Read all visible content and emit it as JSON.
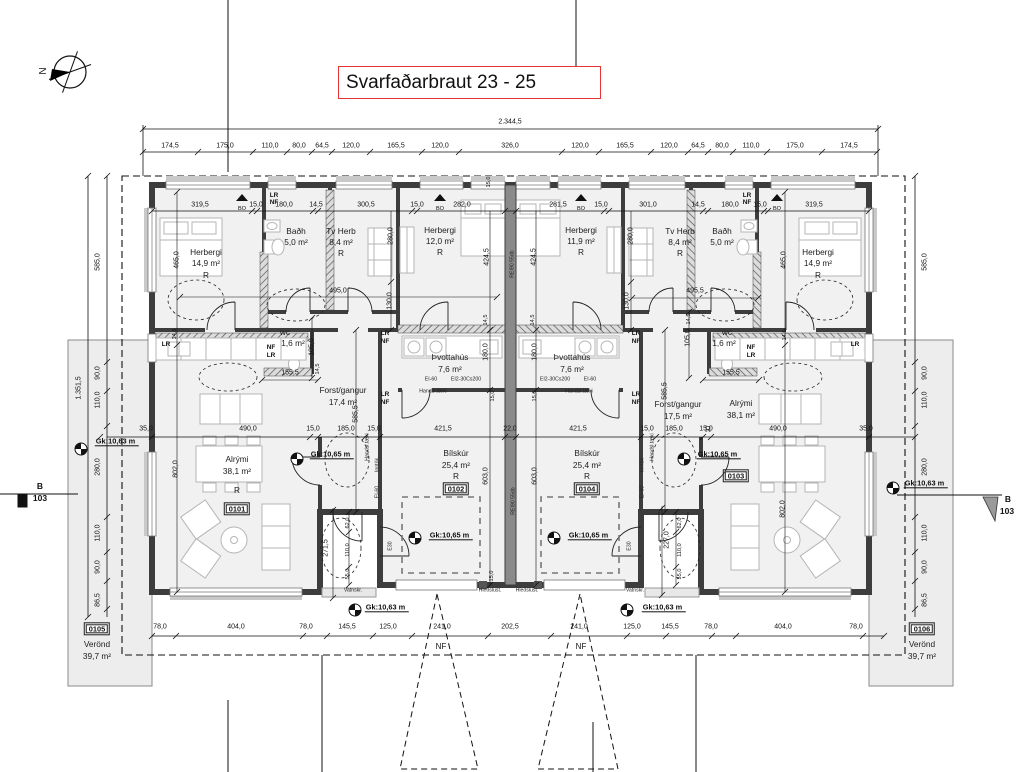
{
  "meta": {
    "title": "Svarfaðarbraut 23 - 25"
  },
  "north_label": "N",
  "colors": {
    "title_box_border": "#e53434",
    "wall": "#3d3d3d",
    "floor": "#f1f1f1",
    "terrace": "#ededed",
    "furniture": "#b5b5b5",
    "line": "#111111"
  },
  "labels": [
    [
      "2.344,5",
      510,
      122,
      "d",
      0
    ],
    [
      "174,5",
      170,
      146,
      "d",
      0
    ],
    [
      "175,0",
      225,
      146,
      "d",
      0
    ],
    [
      "110,0",
      270,
      146,
      "d",
      0
    ],
    [
      "80,0",
      299,
      146,
      "d",
      0
    ],
    [
      "64,5",
      322,
      146,
      "d",
      0
    ],
    [
      "120,0",
      351,
      146,
      "d",
      0
    ],
    [
      "165,5",
      396,
      146,
      "d",
      0
    ],
    [
      "120,0",
      440,
      146,
      "d",
      0
    ],
    [
      "326,0",
      510,
      146,
      "d",
      0
    ],
    [
      "120,0",
      580,
      146,
      "d",
      0
    ],
    [
      "165,5",
      625,
      146,
      "d",
      0
    ],
    [
      "120,0",
      669,
      146,
      "d",
      0
    ],
    [
      "64,5",
      698,
      146,
      "d",
      0
    ],
    [
      "80,0",
      722,
      146,
      "d",
      0
    ],
    [
      "110,0",
      751,
      146,
      "d",
      0
    ],
    [
      "175,0",
      795,
      146,
      "d",
      0
    ],
    [
      "174,5",
      849,
      146,
      "d",
      0
    ],
    [
      "319,5",
      200,
      205,
      "d",
      0
    ],
    [
      "15,0",
      256,
      205,
      "d",
      0
    ],
    [
      "180,0",
      284,
      205,
      "d",
      0
    ],
    [
      "14,5",
      316,
      205,
      "d",
      0
    ],
    [
      "300,5",
      366,
      205,
      "d",
      0
    ],
    [
      "15,0",
      417,
      205,
      "d",
      0
    ],
    [
      "282,0",
      462,
      205,
      "d",
      0
    ],
    [
      "281,5",
      558,
      205,
      "d",
      0
    ],
    [
      "15,0",
      601,
      205,
      "d",
      0
    ],
    [
      "301,0",
      648,
      205,
      "d",
      0
    ],
    [
      "14,5",
      698,
      205,
      "d",
      0
    ],
    [
      "180,0",
      730,
      205,
      "d",
      0
    ],
    [
      "15,0",
      760,
      205,
      "d",
      0
    ],
    [
      "319,5",
      814,
      205,
      "d",
      0
    ],
    [
      "BO",
      242,
      210,
      "ds",
      0
    ],
    [
      "BO",
      440,
      210,
      "ds",
      0
    ],
    [
      "BO",
      581,
      210,
      "ds",
      0
    ],
    [
      "BO",
      777,
      210,
      "ds",
      0
    ],
    [
      "35,0",
      146,
      429,
      "d",
      0
    ],
    [
      "490,0",
      248,
      429,
      "d",
      0
    ],
    [
      "15,0",
      313,
      429,
      "d",
      0
    ],
    [
      "185,0",
      346,
      429,
      "d",
      0
    ],
    [
      "15,0",
      374,
      429,
      "d",
      0
    ],
    [
      "421,5",
      443,
      429,
      "d",
      0
    ],
    [
      "22,0",
      510,
      429,
      "d",
      0
    ],
    [
      "421,5",
      578,
      429,
      "d",
      0
    ],
    [
      "15,0",
      647,
      429,
      "d",
      0
    ],
    [
      "185,0",
      674,
      429,
      "d",
      0
    ],
    [
      "15,0",
      706,
      429,
      "d",
      0
    ],
    [
      "490,0",
      778,
      429,
      "d",
      0
    ],
    [
      "35,0",
      866,
      429,
      "d",
      0
    ],
    [
      "78,0",
      160,
      627,
      "d",
      0
    ],
    [
      "404,0",
      236,
      627,
      "d",
      0
    ],
    [
      "78,0",
      306,
      627,
      "d",
      0
    ],
    [
      "145,5",
      347,
      627,
      "d",
      0
    ],
    [
      "125,0",
      388,
      627,
      "d",
      0
    ],
    [
      "241,0",
      442,
      627,
      "d",
      0
    ],
    [
      "202,5",
      510,
      627,
      "d",
      0
    ],
    [
      "241,0",
      579,
      627,
      "d",
      0
    ],
    [
      "125,0",
      632,
      627,
      "d",
      0
    ],
    [
      "145,5",
      670,
      627,
      "d",
      0
    ],
    [
      "78,0",
      711,
      627,
      "d",
      0
    ],
    [
      "404,0",
      783,
      627,
      "d",
      0
    ],
    [
      "78,0",
      856,
      627,
      "d",
      0
    ],
    [
      "NF",
      441,
      647,
      "nfd",
      0
    ],
    [
      "NF",
      581,
      647,
      "nfd",
      0
    ],
    [
      "495,0",
      338,
      291,
      "d",
      0
    ],
    [
      "495,5",
      695,
      291,
      "d",
      0
    ],
    [
      "155,5",
      290,
      373,
      "d",
      0
    ],
    [
      "155,5",
      731,
      373,
      "d",
      0
    ],
    [
      "585,0",
      98,
      262,
      "d",
      1
    ],
    [
      "90,0",
      98,
      373,
      "d",
      1
    ],
    [
      "110,0",
      98,
      400,
      "d",
      1
    ],
    [
      "280,0",
      98,
      467,
      "d",
      1
    ],
    [
      "110,0",
      98,
      533,
      "d",
      1
    ],
    [
      "90,0",
      98,
      567,
      "d",
      1
    ],
    [
      "86,5",
      98,
      600,
      "d",
      1
    ],
    [
      "1.351,5",
      79,
      388,
      "d",
      1
    ],
    [
      "585,0",
      925,
      262,
      "d",
      1
    ],
    [
      "90,0",
      925,
      373,
      "d",
      1
    ],
    [
      "110,0",
      925,
      400,
      "d",
      1
    ],
    [
      "280,0",
      925,
      467,
      "d",
      1
    ],
    [
      "110,0",
      925,
      533,
      "d",
      1
    ],
    [
      "90,0",
      925,
      567,
      "d",
      1
    ],
    [
      "86,5",
      925,
      600,
      "d",
      1
    ],
    [
      "465,0",
      177,
      260,
      "d",
      1
    ],
    [
      "465,0",
      784,
      260,
      "d",
      1
    ],
    [
      "280,0",
      391,
      236,
      "d",
      1
    ],
    [
      "280,0",
      631,
      236,
      "d",
      1
    ],
    [
      "424,5",
      487,
      257,
      "d",
      1
    ],
    [
      "424,5",
      534,
      257,
      "d",
      1
    ],
    [
      "130,0",
      390,
      301,
      "d",
      1
    ],
    [
      "130,0",
      627,
      301,
      "d",
      1
    ],
    [
      "105,0",
      312,
      347,
      "d",
      1
    ],
    [
      "105,0",
      688,
      338,
      "d",
      1
    ],
    [
      "180,0",
      486,
      352,
      "d",
      1
    ],
    [
      "180,0",
      535,
      352,
      "d",
      1
    ],
    [
      "603,0",
      486,
      476,
      "d",
      1
    ],
    [
      "603,0",
      535,
      476,
      "d",
      1
    ],
    [
      "585,5",
      356,
      414,
      "d",
      1
    ],
    [
      "585,5",
      665,
      391,
      "d",
      1
    ],
    [
      "802,0",
      176,
      469,
      "d",
      1
    ],
    [
      "802,0",
      783,
      509,
      "d",
      1
    ],
    [
      "271,5",
      326,
      548,
      "d",
      1
    ],
    [
      "227,0",
      667,
      540,
      "d",
      1
    ],
    [
      "14,5",
      319,
      369,
      "ds",
      1
    ],
    [
      "14,5",
      690,
      319,
      "ds",
      1
    ],
    [
      "14,5",
      176,
      334,
      "ds",
      1
    ],
    [
      "14,5",
      786,
      335,
      "ds",
      1
    ],
    [
      "14,5",
      487,
      320,
      "ds",
      1
    ],
    [
      "14,5",
      534,
      320,
      "ds",
      1
    ],
    [
      "15,0",
      490,
      182,
      "ds",
      1
    ],
    [
      "15,0",
      494,
      396,
      "ds",
      1
    ],
    [
      "15,0",
      536,
      396,
      "ds",
      1
    ],
    [
      "15,0",
      493,
      576,
      "ds",
      1
    ],
    [
      "62,0",
      349,
      523,
      "ds",
      1
    ],
    [
      "62,0",
      681,
      523,
      "ds",
      1
    ],
    [
      "110,0",
      349,
      550,
      "ds",
      1
    ],
    [
      "110,0",
      681,
      550,
      "ds",
      1
    ],
    [
      "55,0",
      349,
      574,
      "ds",
      1
    ],
    [
      "55,0",
      681,
      574,
      "ds",
      1
    ],
    [
      "Herbergi",
      206,
      252,
      "rm",
      0
    ],
    [
      "14,9 m²",
      206,
      263,
      "rm",
      0
    ],
    [
      "R",
      206,
      275,
      "rm",
      0
    ],
    [
      "Baðh",
      296,
      231,
      "rm",
      0
    ],
    [
      "5,0 m²",
      296,
      242,
      "rm",
      0
    ],
    [
      "Tv Herb",
      341,
      231,
      "rm",
      0
    ],
    [
      "8,4 m²",
      341,
      242,
      "rm",
      0
    ],
    [
      "R",
      341,
      253,
      "rm",
      0
    ],
    [
      "Herbergi",
      440,
      230,
      "rm",
      0
    ],
    [
      "12,0 m²",
      440,
      241,
      "rm",
      0
    ],
    [
      "R",
      440,
      252,
      "rm",
      0
    ],
    [
      "Herbergi",
      581,
      230,
      "rm",
      0
    ],
    [
      "11,9 m²",
      581,
      241,
      "rm",
      0
    ],
    [
      "R",
      581,
      252,
      "rm",
      0
    ],
    [
      "Tv Herb",
      680,
      231,
      "rm",
      0
    ],
    [
      "8,4 m²",
      680,
      242,
      "rm",
      0
    ],
    [
      "R",
      680,
      253,
      "rm",
      0
    ],
    [
      "Baðh",
      722,
      231,
      "rm",
      0
    ],
    [
      "5,0 m²",
      722,
      242,
      "rm",
      0
    ],
    [
      "Herbergi",
      818,
      252,
      "rm",
      0
    ],
    [
      "14,9 m²",
      818,
      263,
      "rm",
      0
    ],
    [
      "R",
      818,
      275,
      "rm",
      0
    ],
    [
      "wc",
      285,
      332,
      "rm",
      0
    ],
    [
      "1,6 m²",
      293,
      343,
      "rm",
      0
    ],
    [
      "wc",
      727,
      332,
      "rm",
      0
    ],
    [
      "1,6 m²",
      724,
      343,
      "rm",
      0
    ],
    [
      "Þvottahús",
      450,
      357,
      "rm",
      0
    ],
    [
      "7,6 m²",
      450,
      369,
      "rm",
      0
    ],
    [
      "Þvottahús",
      572,
      357,
      "rm",
      0
    ],
    [
      "7,6 m²",
      572,
      369,
      "rm",
      0
    ],
    [
      "Forst/gangur",
      343,
      390,
      "rm",
      0
    ],
    [
      "17,4 m²",
      343,
      402,
      "rm",
      0
    ],
    [
      "Forst/gangur",
      678,
      404,
      "rm",
      0
    ],
    [
      "17,5 m²",
      678,
      416,
      "rm",
      0
    ],
    [
      "Alrými",
      237,
      459,
      "rm",
      0
    ],
    [
      "38,1 m²",
      237,
      471,
      "rm",
      0
    ],
    [
      "R",
      237,
      490,
      "rm",
      0
    ],
    [
      "Alrými",
      741,
      403,
      "rm",
      0
    ],
    [
      "38,1 m²",
      741,
      415,
      "rm",
      0
    ],
    [
      "R",
      708,
      429,
      "rm",
      0
    ],
    [
      "Bílskúr",
      456,
      453,
      "rm",
      0
    ],
    [
      "25,4 m²",
      456,
      465,
      "rm",
      0
    ],
    [
      "R",
      456,
      476,
      "rm",
      0
    ],
    [
      "Bílskúr",
      587,
      453,
      "rm",
      0
    ],
    [
      "25,4 m²",
      587,
      465,
      "rm",
      0
    ],
    [
      "R",
      587,
      476,
      "rm",
      0
    ],
    [
      "Verönd",
      97,
      644,
      "rm",
      0
    ],
    [
      "39,7 m²",
      97,
      656,
      "rm",
      0
    ],
    [
      "Verönd",
      922,
      644,
      "rm",
      0
    ],
    [
      "39,7 m²",
      922,
      656,
      "rm",
      0
    ],
    [
      "0101",
      237,
      509,
      "num",
      0
    ],
    [
      "0102",
      456,
      489,
      "num",
      0
    ],
    [
      "0103",
      736,
      476,
      "num",
      0
    ],
    [
      "0104",
      587,
      489,
      "num",
      0
    ],
    [
      "0105",
      97,
      629,
      "num",
      0
    ],
    [
      "0106",
      922,
      629,
      "num",
      0
    ],
    [
      "Gk:10,65 m",
      332,
      455,
      "gk",
      0
    ],
    [
      "Gk:10,65 m",
      719,
      455,
      "gk",
      0
    ],
    [
      "Gk:10,65 m",
      451,
      536,
      "gk",
      0
    ],
    [
      "Gk:10,65 m",
      590,
      536,
      "gk",
      0
    ],
    [
      "Gk:10,63 m",
      387,
      608,
      "gk",
      0
    ],
    [
      "Gk:10,63 m",
      664,
      608,
      "gk",
      0
    ],
    [
      "Gk:10,63 m",
      117,
      442,
      "gk",
      0
    ],
    [
      "Gk:10,63 m",
      926,
      484,
      "gk",
      0
    ],
    [
      "LR",
      274,
      196,
      "nf",
      0
    ],
    [
      "NF",
      274,
      203,
      "nf",
      0
    ],
    [
      "LR",
      747,
      196,
      "nf",
      0
    ],
    [
      "NF",
      747,
      203,
      "nf",
      0
    ],
    [
      "LR",
      166,
      345,
      "nf",
      0
    ],
    [
      "LR",
      855,
      345,
      "nf",
      0
    ],
    [
      "NF",
      271,
      348,
      "nf",
      0
    ],
    [
      "LR",
      271,
      356,
      "nf",
      0
    ],
    [
      "NF",
      751,
      348,
      "nf",
      0
    ],
    [
      "LR",
      751,
      356,
      "nf",
      0
    ],
    [
      "LR",
      385,
      334,
      "nf",
      0
    ],
    [
      "NF",
      385,
      342,
      "nf",
      0
    ],
    [
      "LR",
      636,
      334,
      "nf",
      0
    ],
    [
      "NF",
      636,
      342,
      "nf",
      0
    ],
    [
      "LR",
      385,
      395,
      "nf",
      0
    ],
    [
      "NF",
      385,
      403,
      "nf",
      0
    ],
    [
      "LR",
      636,
      395,
      "nf",
      0
    ],
    [
      "NF",
      636,
      403,
      "nf",
      0
    ],
    [
      "EI-60",
      431,
      380,
      "tech",
      0
    ],
    [
      "EI2-30Cs200",
      466,
      380,
      "tech",
      0
    ],
    [
      "EI2-30Cs200",
      555,
      380,
      "tech",
      0
    ],
    [
      "EI-60",
      590,
      380,
      "tech",
      0
    ],
    [
      "Handsl.tæki",
      433,
      392,
      "tech",
      0
    ],
    [
      "Handsl.tæki",
      579,
      392,
      "tech",
      0
    ],
    [
      "Handsl.tæki",
      368,
      447,
      "tech",
      1
    ],
    [
      "Inntök",
      378,
      465,
      "tech",
      1
    ],
    [
      "EI-60",
      378,
      492,
      "tech",
      1
    ],
    [
      "E30",
      391,
      546,
      "tech",
      1
    ],
    [
      "Handsl.tæki",
      653,
      447,
      "tech",
      1
    ],
    [
      "Inntök",
      643,
      465,
      "tech",
      1
    ],
    [
      "EI-60",
      643,
      492,
      "tech",
      1
    ],
    [
      "E30",
      630,
      546,
      "tech",
      1
    ],
    [
      "REI90 55db",
      513,
      264,
      "tech",
      1
    ],
    [
      "REI90 55db",
      514,
      501,
      "tech",
      1
    ],
    [
      "Vatnskr.",
      353,
      591,
      "tech",
      0
    ],
    [
      "Vatnskr.",
      635,
      591,
      "tech",
      0
    ],
    [
      "Hleðslust.",
      490,
      591,
      "tech",
      0
    ],
    [
      "Hleðslust.",
      527,
      591,
      "tech",
      0
    ],
    [
      "B",
      40,
      486,
      "sec",
      0
    ],
    [
      "103",
      40,
      498,
      "sec",
      0
    ],
    [
      "B",
      1008,
      499,
      "sec",
      0
    ],
    [
      "103",
      1007,
      511,
      "sec",
      0
    ],
    [
      "N",
      44,
      71,
      "north",
      1
    ]
  ]
}
